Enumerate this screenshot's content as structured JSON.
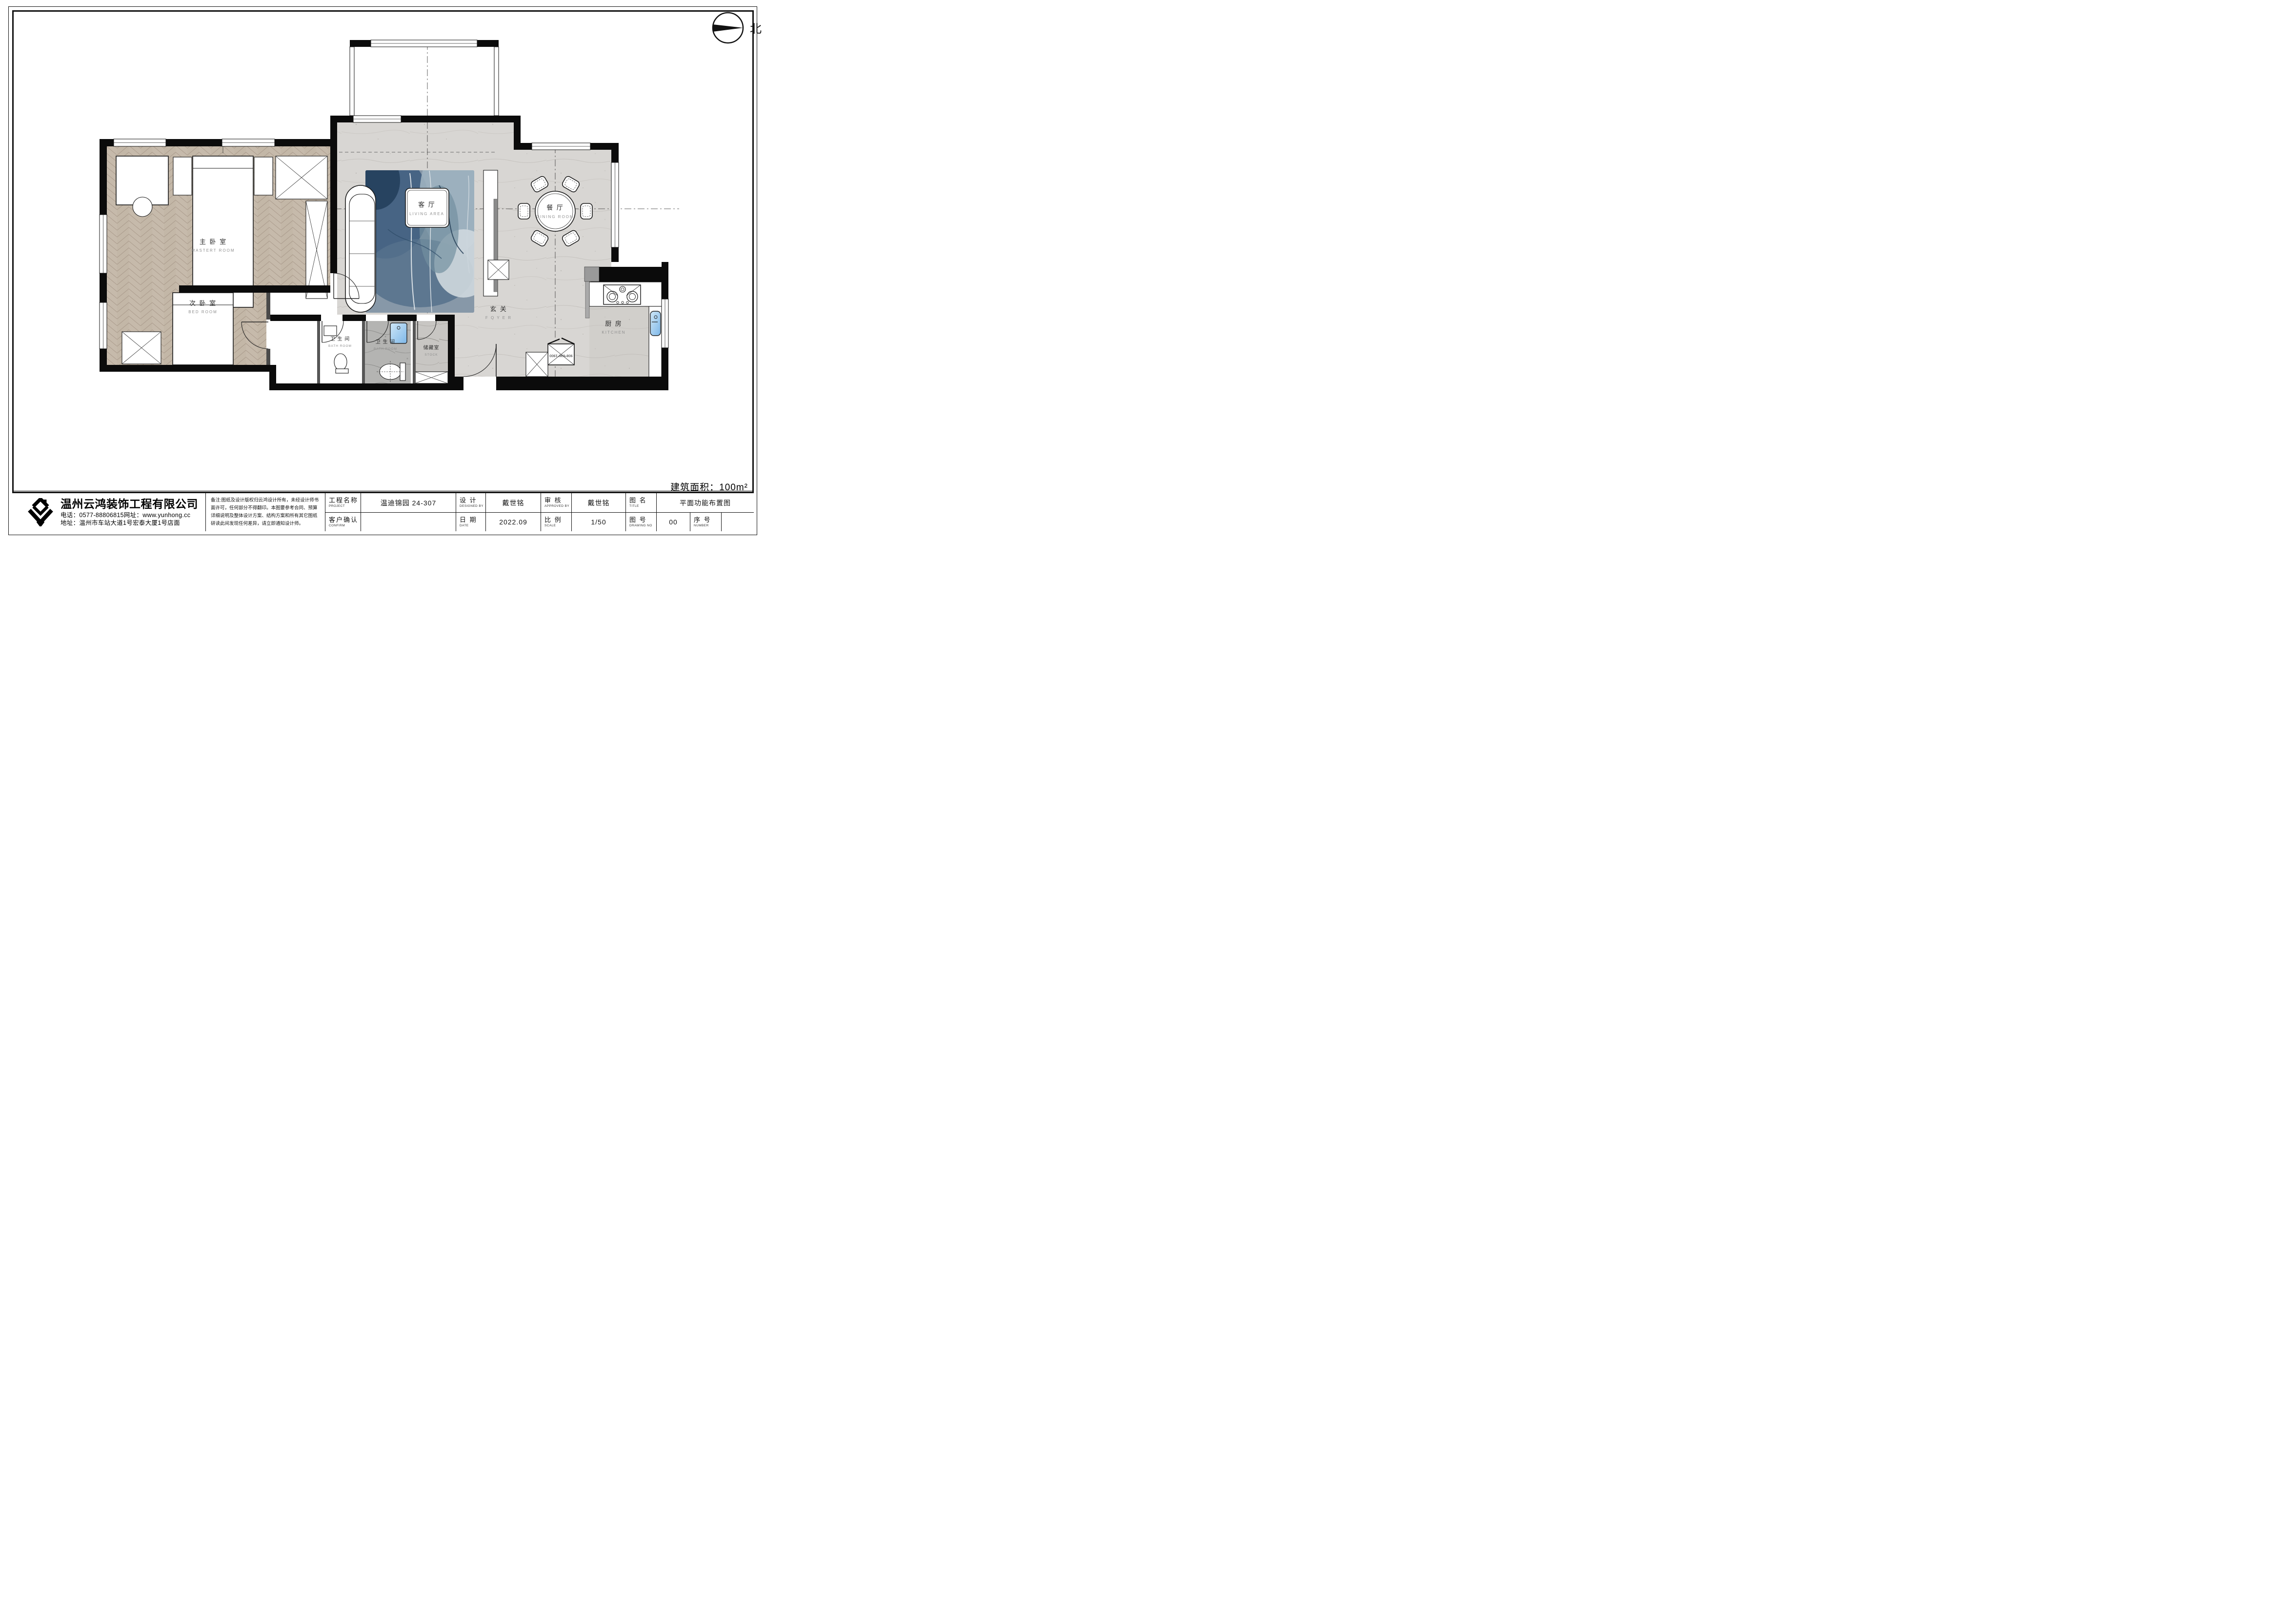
{
  "page": {
    "north_label": "北",
    "area_text": "建筑面积：100m²"
  },
  "plan": {
    "rooms": {
      "master": {
        "zh": "主 卧 室",
        "en": "MASTERT  ROOM"
      },
      "bedroom": {
        "zh": "次 卧 室",
        "en": "BED  ROOM"
      },
      "living": {
        "zh": "客 厅",
        "en": "LIVING  AREA"
      },
      "dining": {
        "zh": "餐 厅",
        "en": "DINING ROOM"
      },
      "foyer": {
        "zh": "玄 关",
        "en": "F O Y E R"
      },
      "kitchen": {
        "zh": "厨 房",
        "en": "KITCHEN"
      },
      "bath1": {
        "zh": "卫 生 间",
        "en": "BATH  ROOM"
      },
      "bath2": {
        "zh": "卫 生 间",
        "en": "BATH  ROOM"
      },
      "store": {
        "zh": "储藏室",
        "en": "STOCK"
      }
    },
    "fridge_label": "908*636*1900"
  },
  "company": {
    "name": "温州云鸿装饰工程有限公司",
    "phone_line": "电话：0577-88806815网址：www.yunhong.cc",
    "address_line": "地址：温州市车站大道1号宏泰大厦1号店面"
  },
  "notes": "备注:图纸及设计版权归云鸿设计所有，未经设计师书面许可，任何部分不得翻印。本图要参考合同、预算详细说明及整体设计方案、结构方案和所有其它图纸研读此间发现任何差异，请立即通知设计师。",
  "title_block": {
    "project_label_zh": "工程名称",
    "project_label_en": "PROJECT",
    "project_value": "温迪锦园 24-307",
    "confirm_label_zh": "客户确认",
    "confirm_label_en": "CONFIRM",
    "confirm_value": "",
    "design_label_zh": "设 计",
    "design_label_en": "DESIGNED BY",
    "design_value": "戴世铭",
    "date_label_zh": "日 期",
    "date_label_en": "DATE",
    "date_value": "2022.09",
    "approve_label_zh": "审 核",
    "approve_label_en": "APPROVED BY",
    "approve_value": "戴世铭",
    "scale_label_zh": "比 例",
    "scale_label_en": "SCALE",
    "scale_value": "1/50",
    "drawingname_label_zh": "图 名",
    "drawingname_label_en": "TITLE",
    "drawingname_value": "平面功能布置图",
    "drawingno_label_zh": "图 号",
    "drawingno_label_en": "DRAWING NO",
    "drawingno_value": "00",
    "number_label_zh": "序 号",
    "number_label_en": "NUMBER",
    "number_value": ""
  }
}
